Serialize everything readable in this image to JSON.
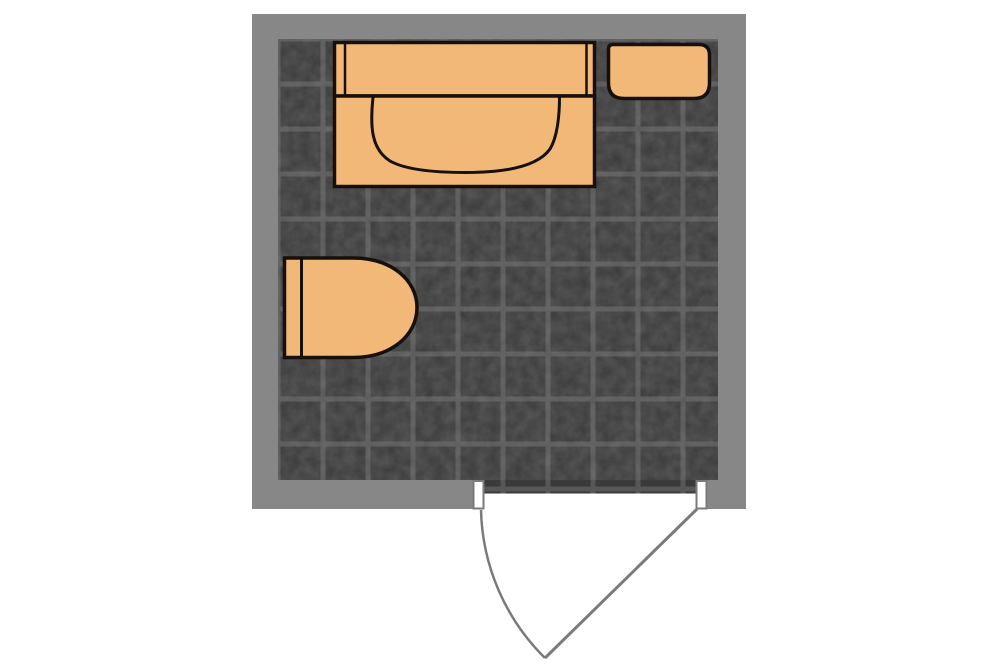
{
  "plan": {
    "kind": "bathroom-floor-plan",
    "colors": {
      "background": "#ffffff",
      "wall": "#878787",
      "floor_tile": "#3a3a3a",
      "floor_grout": "#575757",
      "fixture_fill": "#f2b878",
      "fixture_outline": "#17100a",
      "door_line": "#7a7a7a",
      "jamb_fill": "#ffffff"
    },
    "room": {
      "wall": {
        "x": 252,
        "y": 14,
        "w": 494,
        "h": 495
      },
      "floor": {
        "x": 278,
        "y": 39,
        "w": 440,
        "h": 441
      },
      "tile_size": 45
    },
    "fixtures": {
      "bathtub": {
        "label": "bathtub",
        "deck": {
          "x": 334.5,
          "y": 42.5,
          "w": 260,
          "h": 53.5
        },
        "deck_line_left": {
          "x1": 345,
          "y1": 42.5,
          "x2": 345,
          "y2": 96
        },
        "deck_line_right": {
          "x1": 586.5,
          "y1": 42.5,
          "x2": 586.5,
          "y2": 96
        },
        "body": {
          "x": 334.5,
          "y": 96,
          "w": 260,
          "h": 90.5
        },
        "basin_path": "M 373 97.5 C 370 126 371 149 390 161 C 406 170 434 172.5 466 172.5 C 506 172.5 538 166 550 149 C 558 136 559.5 112 559.5 97.5"
      },
      "sink": {
        "label": "sink",
        "path": "M 613 44.5 L 699 44.5 Q 709.5 44.5 709.5 55 L 709.5 83 Q 709.5 98.5 694 98.5 L 624 98.5 Q 608.5 98.5 608.5 83 L 608.5 49 Q 608.5 44.5 613 44.5 Z"
      },
      "toilet": {
        "label": "toilet",
        "path": "M 284.5 258 L 353 258 C 391 258 417 280 417 307.5 C 417 335.5 391 357.5 353 357.5 L 284.5 357.5 Z",
        "tank_line": {
          "x1": 301.5,
          "y1": 258,
          "x2": 301.5,
          "y2": 357.5
        }
      },
      "door": {
        "label": "door",
        "threshold": {
          "x": 483.5,
          "y": 480,
          "w": 213,
          "h": 13.5
        },
        "opening_cut": {
          "x": 483.5,
          "y": 493.5,
          "w": 213,
          "h": 16.5
        },
        "jamb_left": {
          "x": 473.5,
          "y": 481,
          "w": 10,
          "h": 27.5
        },
        "jamb_right": {
          "x": 696.5,
          "y": 481,
          "w": 10,
          "h": 27.5
        },
        "leaf": {
          "x1": 697,
          "y1": 509,
          "x2": 545,
          "y2": 658
        },
        "arc_path": "M 481 510 A 215 215 0 0 0 545 658"
      }
    }
  }
}
